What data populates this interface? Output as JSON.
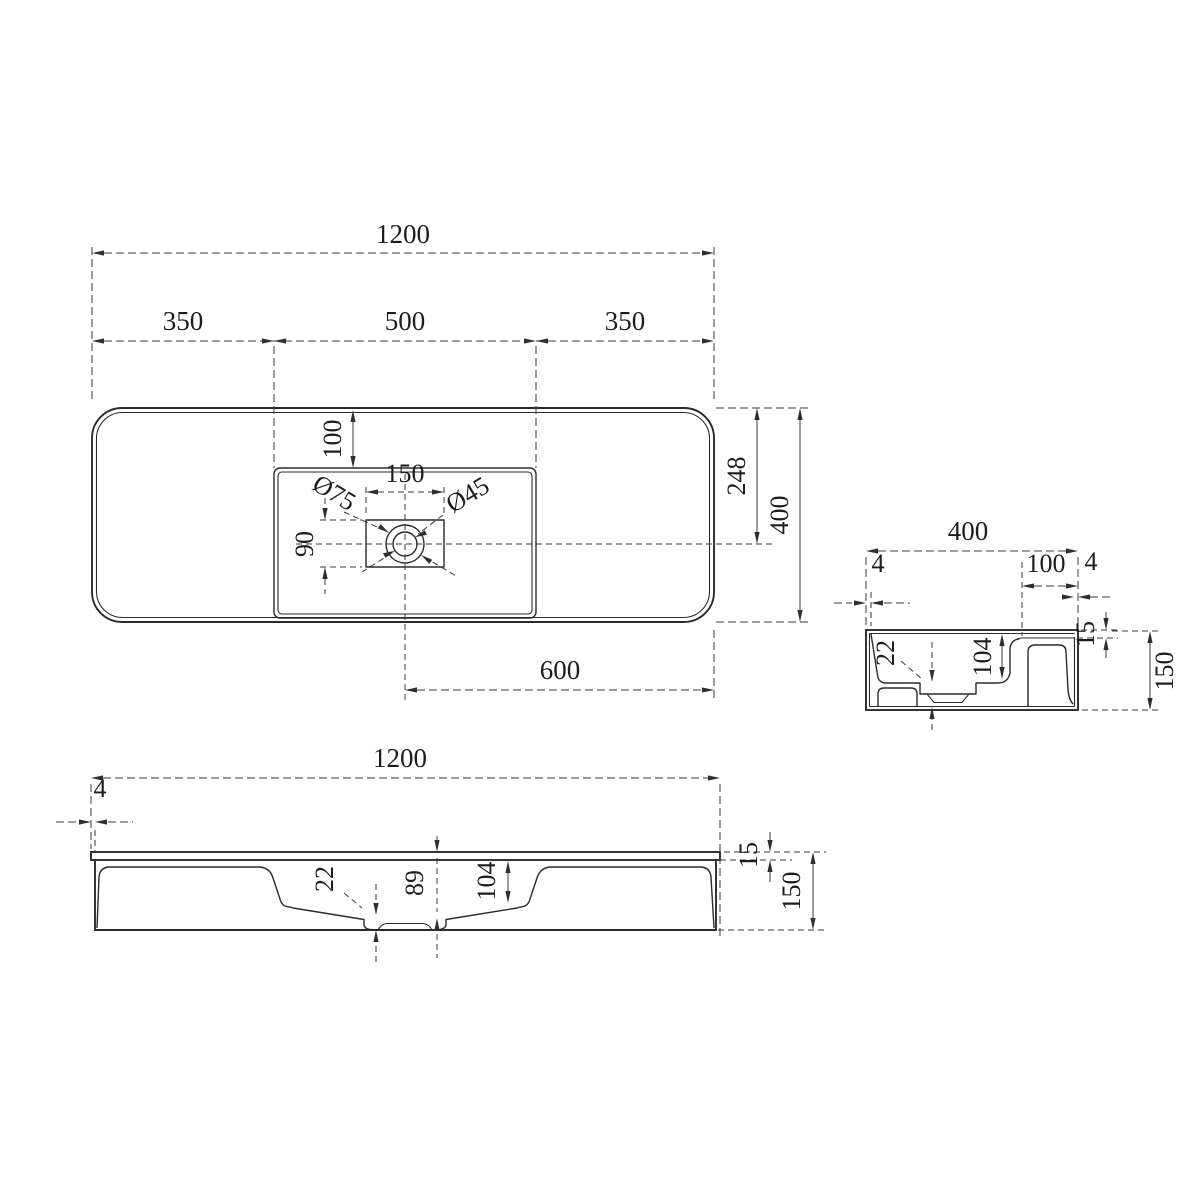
{
  "colors": {
    "line": "#2b2b2b",
    "background": "#ffffff"
  },
  "views": {
    "top": {
      "dims": {
        "overall_width": "1200",
        "seg_left": "350",
        "seg_center": "500",
        "seg_right": "350",
        "recess_offset": "100",
        "faucet_rect_width": "150",
        "drain_outer_dia": "Ø75",
        "drain_inner_dia": "Ø45",
        "faucet_rect_height": "90",
        "edge_to_drain_center": "248",
        "depth": "400",
        "drain_center_to_edge": "600"
      }
    },
    "side": {
      "dims": {
        "width": "400",
        "lip_left": "4",
        "deck_width": "100",
        "lip_right": "4",
        "wall_thickness": "22",
        "bowl_depth": "104",
        "rim_height": "15",
        "total_height": "150"
      }
    },
    "front": {
      "dims": {
        "overall_width": "1200",
        "lip_overhang": "4",
        "wall_thickness": "22",
        "drain_depth": "89",
        "bowl_depth": "104",
        "rim_height": "15",
        "total_height": "150"
      }
    }
  }
}
